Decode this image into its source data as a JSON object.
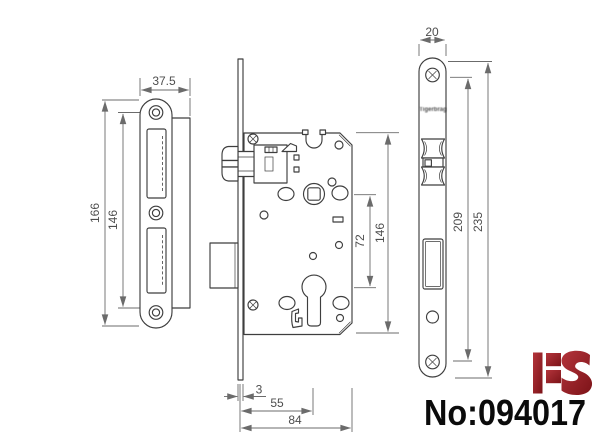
{
  "title": "Mortise lock technical drawing",
  "strike": {
    "width": "37.5",
    "length": "166",
    "screw_span": "146"
  },
  "body": {
    "height": "146",
    "center_distance": "72",
    "plate_thickness": "3",
    "backset": "55",
    "depth": "84"
  },
  "face": {
    "width": "20",
    "screw_span": "209",
    "length": "235",
    "stamp": "Tigerbrag"
  },
  "footer": {
    "logo": "HS",
    "part_number": "No:094017"
  },
  "colors": {
    "outline": "#3e3e3e",
    "dimension": "#6b6b6b",
    "dim_text": "#4d4d4d",
    "logo_red_dark": "#7c1318",
    "logo_red_light": "#b4343b",
    "part_number": "#0b0b0b",
    "background": "#ffffff"
  }
}
